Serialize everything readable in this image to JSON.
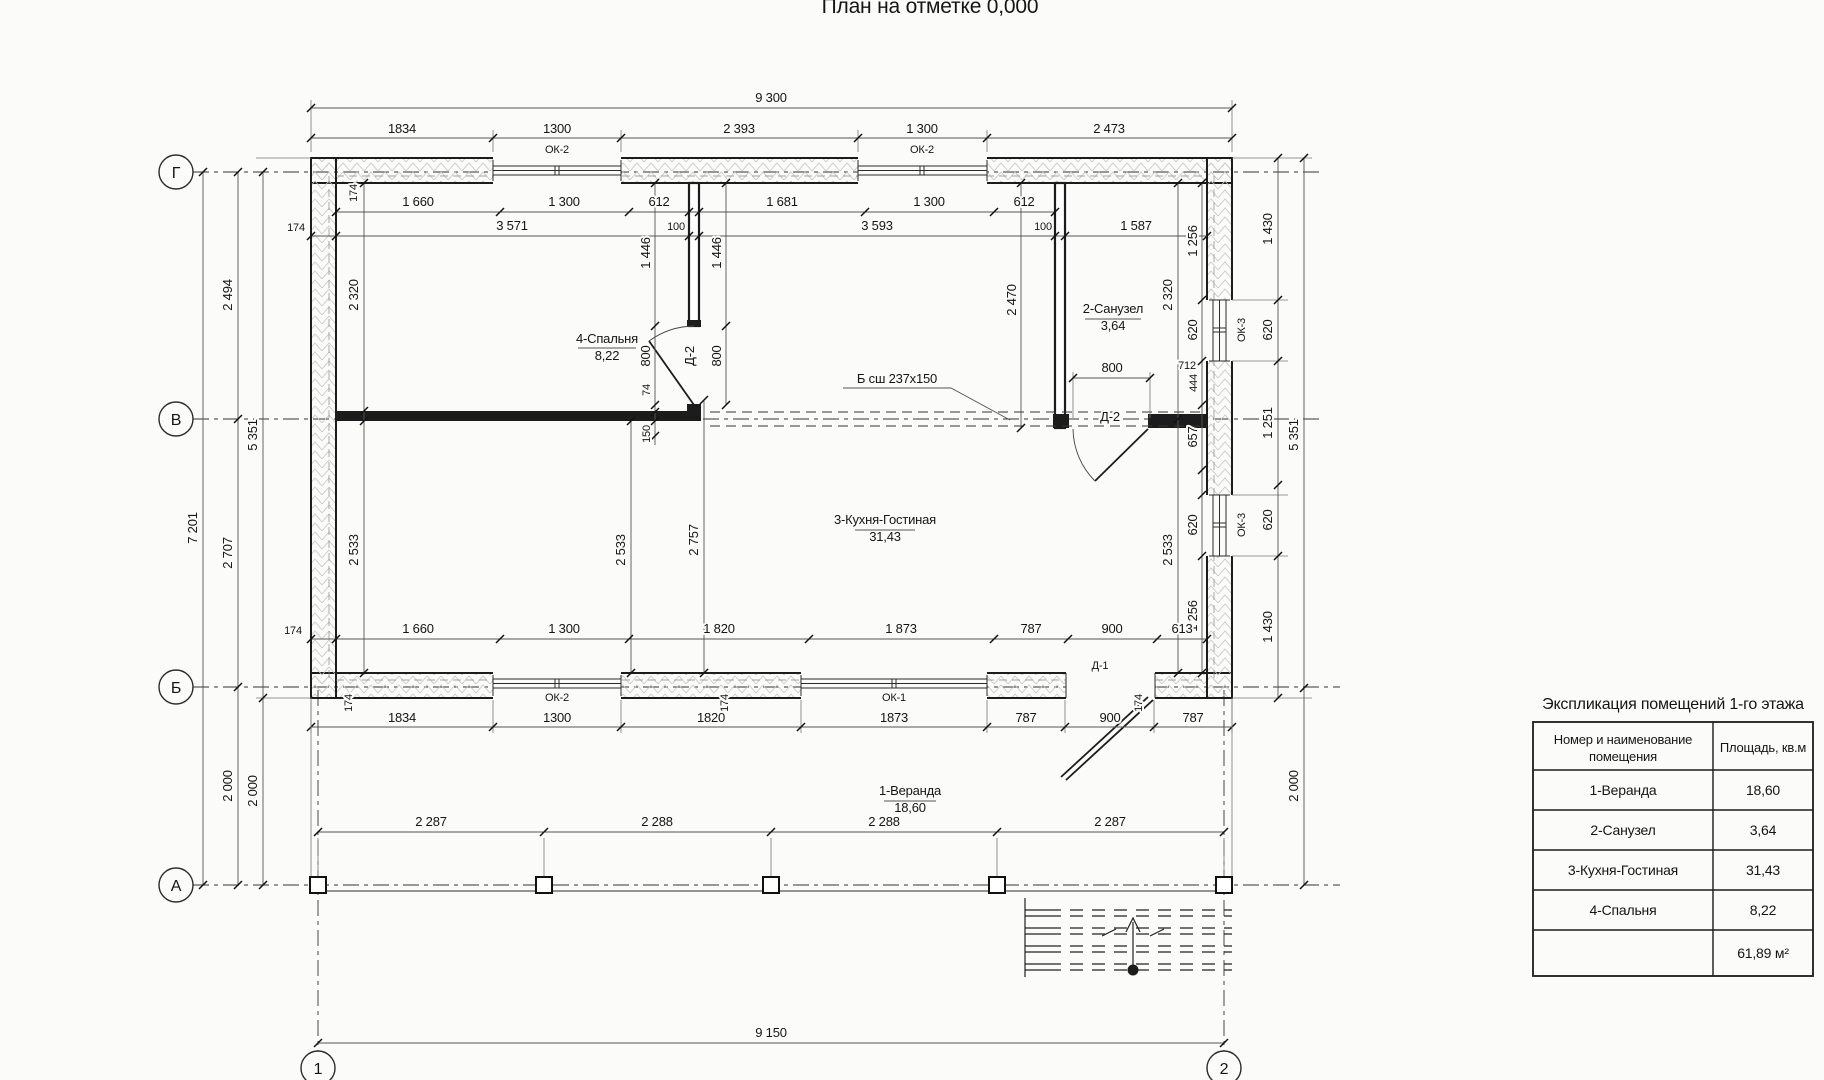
{
  "title": "План на отметке 0,000",
  "axes": {
    "r1": "Г",
    "r2": "В",
    "r3": "Б",
    "r4": "А",
    "c1": "1",
    "c2": "2"
  },
  "openings": {
    "ok1": "ОК-1",
    "ok2": "ОК-2",
    "ok3": "ОК-3",
    "d1": "Д-1",
    "d2": "Д-2"
  },
  "beam_note": "Б сш 237x150",
  "rooms": {
    "veranda": {
      "name": "1-Веранда",
      "area": "18,60"
    },
    "san": {
      "name": "2-Санузел",
      "area": "3,64"
    },
    "kitchen": {
      "name": "3-Кухня-Гостиная",
      "area": "31,43"
    },
    "bedroom": {
      "name": "4-Спальня",
      "area": "8,22"
    }
  },
  "dims": {
    "overall_top": "9 300",
    "overall_bottom": "9 150",
    "top": [
      "1834",
      "1300",
      "2 393",
      "1 300",
      "2 473"
    ],
    "row_c": [
      "1 660",
      "1 300",
      "612",
      "1 681",
      "1 300",
      "612"
    ],
    "row_d": [
      "3 571",
      "100",
      "3 593",
      "100",
      "1 587"
    ],
    "off_174": "174",
    "left": {
      "gv": "2 494",
      "vb": "2 707",
      "ba": "2 000",
      "ba2": "2 000",
      "total": "7 201",
      "gb": "5 351"
    },
    "right": {
      "c1": [
        "1 430",
        "620",
        "1 251",
        "620",
        "1 430"
      ],
      "total": "5 351",
      "ba": "2 000",
      "inner": [
        "1 256",
        "620",
        "444",
        "657",
        "620",
        "1 256"
      ],
      "w712": "712"
    },
    "interior": {
      "bed_h": "2 320",
      "bed_w1": "1 446",
      "bed_w2": "1 446",
      "door1": "800",
      "door2": "800",
      "j74": "74",
      "j150": "150",
      "san_wall": "2 470",
      "san_h": "2 320",
      "san_door": "800",
      "k1": "2 533",
      "k2": "2 533",
      "k3": "2 757",
      "k4": "2 533"
    },
    "row_g": [
      "1 660",
      "1 300",
      "1 820",
      "1 873",
      "787",
      "900",
      "613"
    ],
    "row_h": [
      "1834",
      "1300",
      "1820",
      "1873",
      "787",
      "900",
      "787"
    ],
    "veranda": [
      "2 287",
      "2 288",
      "2 288",
      "2 287"
    ]
  },
  "table": {
    "title": "Экспликация помещений 1-го этажа",
    "h1a": "Номер и наименование",
    "h1b": "помещения",
    "h2": "Площадь, кв.м",
    "rows": [
      {
        "name": "1-Веранда",
        "area": "18,60"
      },
      {
        "name": "2-Санузел",
        "area": "3,64"
      },
      {
        "name": "3-Кухня-Гостиная",
        "area": "31,43"
      },
      {
        "name": "4-Спальня",
        "area": "8,22"
      }
    ],
    "total": "61,89 м²"
  }
}
